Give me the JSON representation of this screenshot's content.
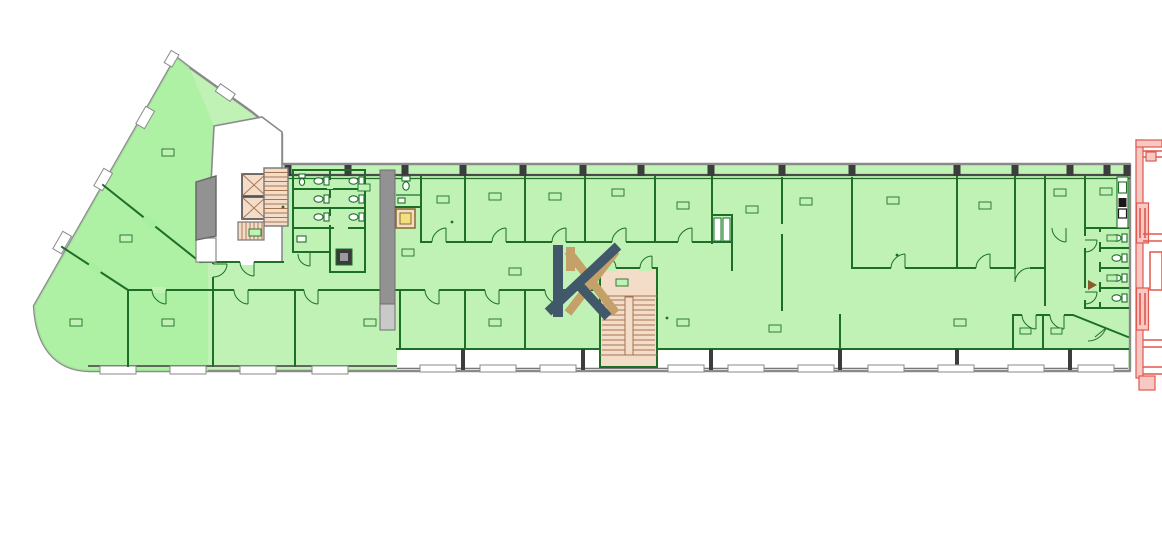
{
  "meta": {
    "type": "architectural-floor-plan",
    "background": "#ffffff",
    "description": "Office floor plan, rooms highlighted green, stair/elevator cores tan, neighbouring building outlined red at right edge, K-monogram watermark at centre"
  },
  "colors": {
    "room": "#c0f2b6",
    "roomWing": "#a9efa0",
    "wallGreen": "#1d6f28",
    "wallGray": "#8a8a8a",
    "grayShaft": "#929292",
    "stairFill": "#f3dcc8",
    "stairLine": "#a6734f",
    "yellowFill": "#f2df7e",
    "yellowBorder": "#8a6a28",
    "red": "#e2574e",
    "redFill": "#f6c9c4",
    "logoDark": "#41586b",
    "logoGold": "#c3a169",
    "sillStroke": "#8a8a8a",
    "pillar": "#3c3c3c",
    "ink": "#2a2a2a"
  },
  "logo": {
    "name": "K monogram watermark",
    "front": "dark slate K",
    "back": "gold K"
  },
  "inventory": {
    "elevators": 2,
    "staircases": 3,
    "wc_stalls_left_block": 6,
    "wc_stalls_right_block": 4,
    "kitchenette": 1
  }
}
